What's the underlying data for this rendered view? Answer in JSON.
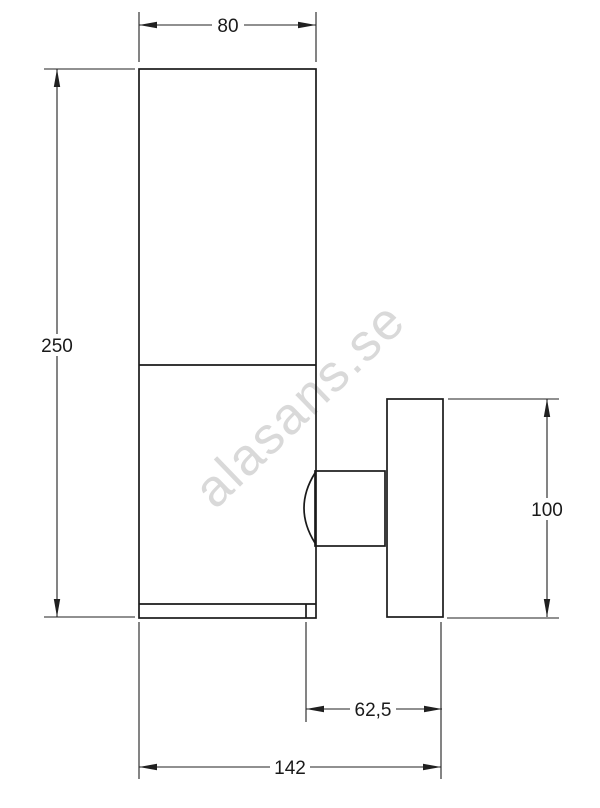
{
  "page": {
    "background_color": "#ffffff",
    "description_visible_content": "Technical dimension drawing of a wall-mounted lamp, side elevation"
  },
  "watermark": {
    "text": "alasans.se",
    "color": "#d9d9d9"
  },
  "drawing": {
    "line_color": "#1a1a1a",
    "dimensions": {
      "body_width": {
        "label": "80"
      },
      "body_height": {
        "label": "250"
      },
      "bracket_height": {
        "label": "100"
      },
      "bracket_offset": {
        "label": "62,5"
      },
      "total_depth": {
        "label": "142"
      }
    }
  }
}
